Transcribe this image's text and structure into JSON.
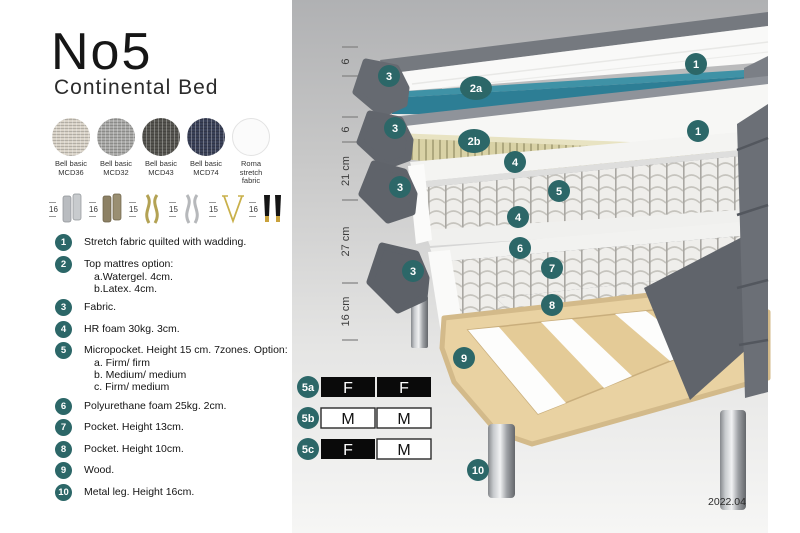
{
  "title": "No5",
  "subtitle": "Continental Bed",
  "swatches": [
    {
      "line1": "Bell basic",
      "line2": "MCD36",
      "color": "#d9d3c8"
    },
    {
      "line1": "Bell basic",
      "line2": "MCD32",
      "color": "#a9a9a7"
    },
    {
      "line1": "Bell basic",
      "line2": "MCD43",
      "color": "#55544f"
    },
    {
      "line1": "Bell basic",
      "line2": "MCD74",
      "color": "#3a4158"
    },
    {
      "line1": "Roma",
      "line2": "stretch fabric",
      "color": "#fbfbfb"
    }
  ],
  "legs": [
    {
      "size": "16",
      "name": "cylinder-silver"
    },
    {
      "size": "16",
      "name": "cylinder-bronze"
    },
    {
      "size": "15",
      "name": "twisted-gold"
    },
    {
      "size": "15",
      "name": "twisted-silver"
    },
    {
      "size": "15",
      "name": "hairpin-gold"
    },
    {
      "size": "16",
      "name": "tapered-black-gold"
    }
  ],
  "list": [
    {
      "num": "1",
      "text": "Stretch fabric quilted with wadding."
    },
    {
      "num": "2",
      "text": "Top mattres option:",
      "sub": [
        "a.Watergel. 4cm.",
        "b.Latex. 4cm."
      ]
    },
    {
      "num": "3",
      "text": "Fabric."
    },
    {
      "num": "4",
      "text": "HR foam 30kg. 3cm."
    },
    {
      "num": "5",
      "text": "Micropocket. Height 15 cm. 7zones. Option:",
      "sub": [
        "a. Firm/ firm",
        "b. Medium/ medium",
        "c. Firm/ medium"
      ]
    },
    {
      "num": "6",
      "text": "Polyurethane foam 25kg. 2cm."
    },
    {
      "num": "7",
      "text": "Pocket. Height 13cm."
    },
    {
      "num": "8",
      "text": "Pocket. Height 10cm."
    },
    {
      "num": "9",
      "text": "Wood."
    },
    {
      "num": "10",
      "text": "Metal leg. Height 16cm."
    }
  ],
  "diagram": {
    "dimensions": [
      "6",
      "6",
      "21 cm",
      "27 cm",
      "16 cm"
    ],
    "callouts": {
      "c1": "1",
      "c2a": "2a",
      "c2b": "2b",
      "c3": "3",
      "c4": "4",
      "c5": "5",
      "c6": "6",
      "c7": "7",
      "c8": "8",
      "c9": "9",
      "c10": "10"
    },
    "accent_teal": "#2c6768",
    "core_teal": "#2d7e95",
    "version": "2022.04"
  },
  "firmness": [
    {
      "label": "5a",
      "cells": [
        {
          "text": "F",
          "style": "dark"
        },
        {
          "text": "F",
          "style": "dark"
        }
      ]
    },
    {
      "label": "5b",
      "cells": [
        {
          "text": "M",
          "style": "light"
        },
        {
          "text": "M",
          "style": "light"
        }
      ]
    },
    {
      "label": "5c",
      "cells": [
        {
          "text": "F",
          "style": "dark"
        },
        {
          "text": "M",
          "style": "light"
        }
      ]
    }
  ]
}
